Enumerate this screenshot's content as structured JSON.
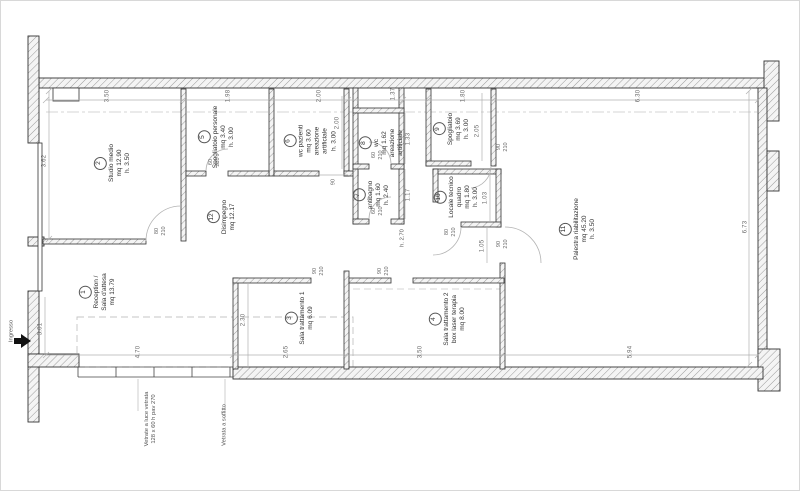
{
  "entrance": {
    "label": "Ingresso"
  },
  "notes": {
    "glazing_line1": "Vetrate a luce vetrata",
    "glazing_line2": "128 x 60 h pav 270",
    "ceiling": "Vetrata a soffitto",
    "height_local": "h. 2.70"
  },
  "rooms": {
    "r1": {
      "num": "1",
      "l1": "Reception /",
      "l2": "Sala d'attesa",
      "l3": "mq 13.79"
    },
    "r2": {
      "num": "2",
      "l1": "Studio medio",
      "l2": "mq 12.90",
      "l3": "h. 3.50"
    },
    "r3": {
      "num": "3",
      "l1": "Sala trattamento 1",
      "l2": "mq 6.09"
    },
    "r4": {
      "num": "4",
      "l1": "Sala trattamento 2",
      "l2": "box laser terapia",
      "l3": "mq 8.00"
    },
    "r5": {
      "num": "5",
      "l1": "Spogliatoio personale",
      "l2": "mq 3.40",
      "l3": "h. 3.00"
    },
    "r6": {
      "num": "6",
      "l1": "wc pazienti",
      "l2": "mq 3.60",
      "l3": "areazione",
      "l4": "artificiale",
      "l5": "h. 3.00"
    },
    "r7": {
      "num": "7",
      "l1": "antibagno",
      "l2": "mq 1.60",
      "l3": "h. 2.40"
    },
    "r8": {
      "num": "8",
      "l1": "wc",
      "l2": "mq 1.62",
      "l3": "areazione",
      "l4": "artificiale"
    },
    "r9": {
      "num": "9",
      "l1": "Spogliatoio",
      "l2": "mq 3.69",
      "l3": "h. 3.00"
    },
    "r10": {
      "num": "10",
      "l1": "Locale tecnico",
      "l2": "quadro",
      "l3": "mq 1.80",
      "l4": "h. 3.00"
    },
    "r11": {
      "num": "11",
      "l1": "Palestra riabilitazione",
      "l2": "mq 45.20",
      "l3": "h. 3.50"
    },
    "r12": {
      "num": "12",
      "l1": "Disimpegno",
      "l2": "mq 12.17"
    }
  },
  "dims": {
    "top_1": "3.50",
    "top_2": "1.98",
    "top_3": "2.00",
    "top_4": "1.37",
    "top_5": "1.80",
    "top_6": "6.30",
    "left_1": "3.62",
    "left_2": "3.01",
    "right_1": "6.73",
    "bottom_1": "4.70",
    "bottom_2": "2.65",
    "bottom_3": "3.50",
    "bottom_4": "5.94",
    "room3_h": "2.30",
    "room6_h": "2.00",
    "room8_h": "1.33",
    "room7_h": "1.17",
    "room9_h": "2.05",
    "room10_h": "1.03",
    "pal_door": "1.05"
  },
  "doors": {
    "w60": "60",
    "w80": "80",
    "w90": "90",
    "h210": "210"
  }
}
